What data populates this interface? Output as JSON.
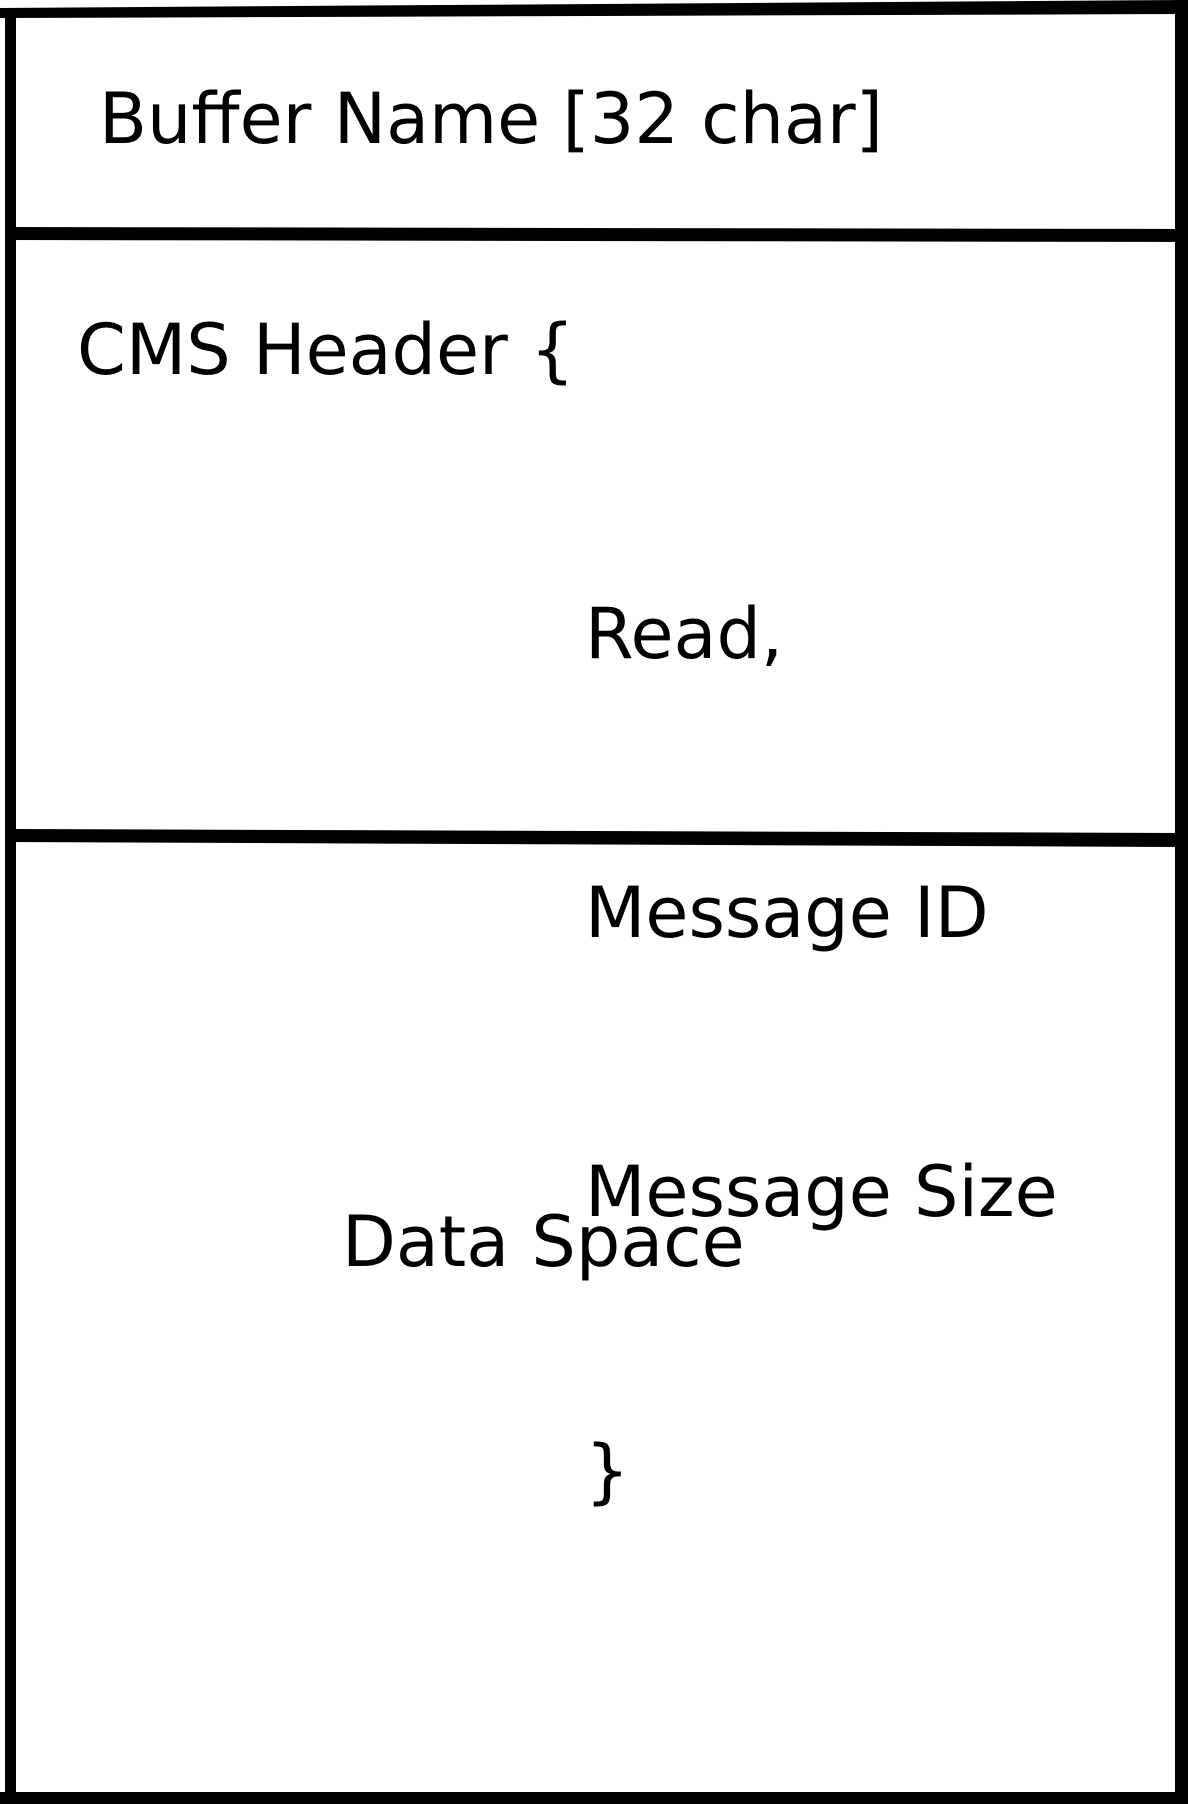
{
  "diagram": {
    "sections": {
      "buffer_name": {
        "label": "Buffer Name [32 char]"
      },
      "cms_header": {
        "open_line": "CMS Header {",
        "fields": [
          "Read,",
          "Message ID",
          "Message Size"
        ],
        "close_brace": "}"
      },
      "data_space": {
        "label": "Data Space"
      }
    },
    "colors": {
      "line": "#000000",
      "background": "#ffffff",
      "text": "#000000"
    }
  }
}
